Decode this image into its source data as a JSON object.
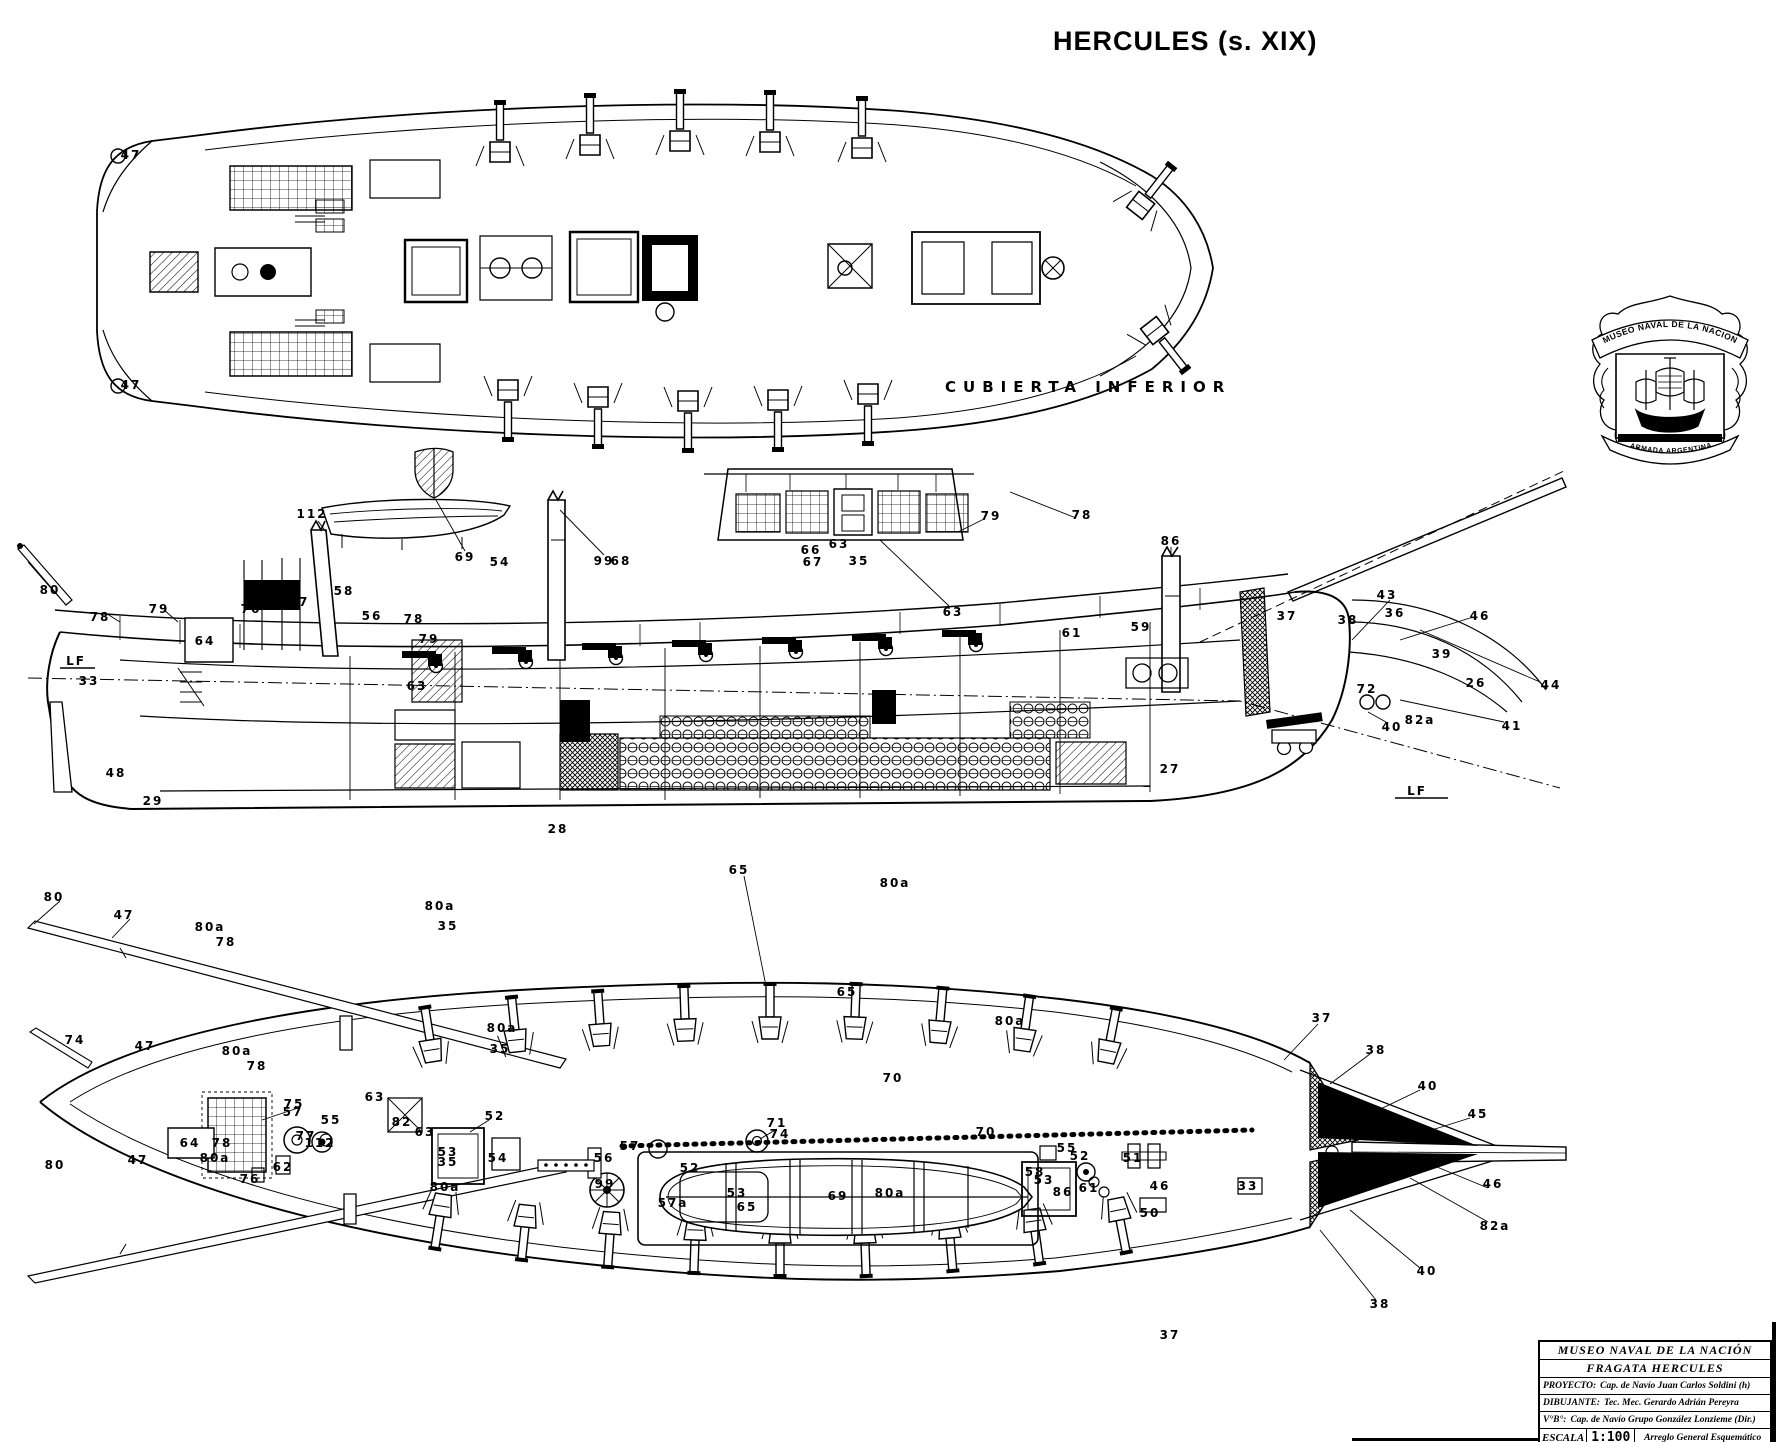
{
  "page_title": "HERCULES (s. XIX)",
  "palette": {
    "ink": "#000000",
    "paper": "#ffffff"
  },
  "crest": {
    "top_banner": "MUSEO NAVAL DE LA NACION",
    "bottom_banner": "ARMADA ARGENTINA"
  },
  "title_block": {
    "line1": "MUSEO NAVAL DE LA NACIÓN",
    "line2": "FRAGATA HERCULES",
    "proyecto_label": "PROYECTO:",
    "proyecto_value": "Cap. de Navío Juan Carlos Soldini (h)",
    "dibujante_label": "DIBUJANTE:",
    "dibujante_value": "Tec. Mec. Gerardo Adrián Pereyra",
    "vb_label": "V°B°:",
    "vb_value": "Cap. de Navío Grupo González Lonzieme (Dir.)",
    "escala_label": "ESCALA",
    "escala_value": "1:100",
    "drawing_title": "Arreglo General Esquemático"
  },
  "views": [
    {
      "key": "cubierta-inferior-plan",
      "label": "CUBIERTA INFERIOR",
      "callouts": [
        {
          "t": "47",
          "x": 131,
          "y": 155
        },
        {
          "t": "47",
          "x": 131,
          "y": 385
        }
      ]
    },
    {
      "key": "longitudinal-section",
      "label": "",
      "callouts": [
        {
          "t": "80",
          "x": 50,
          "y": 590
        },
        {
          "t": "78",
          "x": 100,
          "y": 617
        },
        {
          "t": "79",
          "x": 159,
          "y": 609
        },
        {
          "t": "64",
          "x": 205,
          "y": 641
        },
        {
          "t": "76",
          "x": 251,
          "y": 609
        },
        {
          "t": "77",
          "x": 299,
          "y": 602
        },
        {
          "t": "112",
          "x": 312,
          "y": 514
        },
        {
          "t": "58",
          "x": 344,
          "y": 591
        },
        {
          "t": "56",
          "x": 372,
          "y": 616
        },
        {
          "t": "78",
          "x": 414,
          "y": 619
        },
        {
          "t": "79",
          "x": 429,
          "y": 639
        },
        {
          "t": "33",
          "x": 89,
          "y": 681
        },
        {
          "t": "63",
          "x": 417,
          "y": 686
        },
        {
          "t": "69",
          "x": 465,
          "y": 557
        },
        {
          "t": "54",
          "x": 500,
          "y": 562
        },
        {
          "t": "99",
          "x": 604,
          "y": 561
        },
        {
          "t": "68",
          "x": 621,
          "y": 561
        },
        {
          "t": "63",
          "x": 839,
          "y": 544
        },
        {
          "t": "66",
          "x": 811,
          "y": 550
        },
        {
          "t": "67",
          "x": 813,
          "y": 562
        },
        {
          "t": "35",
          "x": 859,
          "y": 561
        },
        {
          "t": "79",
          "x": 991,
          "y": 516
        },
        {
          "t": "78",
          "x": 1082,
          "y": 515
        },
        {
          "t": "63",
          "x": 953,
          "y": 612
        },
        {
          "t": "86",
          "x": 1171,
          "y": 541
        },
        {
          "t": "61",
          "x": 1072,
          "y": 633
        },
        {
          "t": "59",
          "x": 1141,
          "y": 627
        },
        {
          "t": "37",
          "x": 1287,
          "y": 616
        },
        {
          "t": "38",
          "x": 1348,
          "y": 620
        },
        {
          "t": "43",
          "x": 1387,
          "y": 595
        },
        {
          "t": "36",
          "x": 1395,
          "y": 613
        },
        {
          "t": "46",
          "x": 1480,
          "y": 616
        },
        {
          "t": "39",
          "x": 1442,
          "y": 654
        },
        {
          "t": "26",
          "x": 1476,
          "y": 683
        },
        {
          "t": "44",
          "x": 1551,
          "y": 685
        },
        {
          "t": "72",
          "x": 1367,
          "y": 689
        },
        {
          "t": "40",
          "x": 1392,
          "y": 727
        },
        {
          "t": "82a",
          "x": 1420,
          "y": 720
        },
        {
          "t": "41",
          "x": 1512,
          "y": 726
        },
        {
          "t": "LF",
          "x": 76,
          "y": 661
        },
        {
          "t": "LF",
          "x": 1417,
          "y": 791
        },
        {
          "t": "27",
          "x": 1170,
          "y": 769
        },
        {
          "t": "48",
          "x": 116,
          "y": 773
        },
        {
          "t": "29",
          "x": 153,
          "y": 801
        },
        {
          "t": "28",
          "x": 558,
          "y": 829
        }
      ]
    },
    {
      "key": "upper-deck-plan",
      "label": "",
      "callouts": [
        {
          "t": "80",
          "x": 54,
          "y": 897
        },
        {
          "t": "47",
          "x": 124,
          "y": 915
        },
        {
          "t": "80a",
          "x": 210,
          "y": 927
        },
        {
          "t": "78",
          "x": 226,
          "y": 942
        },
        {
          "t": "80a",
          "x": 440,
          "y": 906
        },
        {
          "t": "35",
          "x": 448,
          "y": 926
        },
        {
          "t": "65",
          "x": 739,
          "y": 870
        },
        {
          "t": "80a",
          "x": 895,
          "y": 883
        },
        {
          "t": "37",
          "x": 1322,
          "y": 1018
        },
        {
          "t": "38",
          "x": 1376,
          "y": 1050
        },
        {
          "t": "40",
          "x": 1428,
          "y": 1086
        },
        {
          "t": "45",
          "x": 1478,
          "y": 1114
        },
        {
          "t": "47",
          "x": 145,
          "y": 1046
        },
        {
          "t": "80a",
          "x": 237,
          "y": 1051
        },
        {
          "t": "78",
          "x": 257,
          "y": 1066
        },
        {
          "t": "80a",
          "x": 502,
          "y": 1028
        },
        {
          "t": "35",
          "x": 500,
          "y": 1049
        },
        {
          "t": "65",
          "x": 847,
          "y": 992
        },
        {
          "t": "80a",
          "x": 1010,
          "y": 1021
        },
        {
          "t": "75",
          "x": 294,
          "y": 1104
        },
        {
          "t": "77",
          "x": 306,
          "y": 1136
        },
        {
          "t": "63",
          "x": 425,
          "y": 1132
        },
        {
          "t": "57",
          "x": 293,
          "y": 1112
        },
        {
          "t": "55",
          "x": 331,
          "y": 1120
        },
        {
          "t": "112",
          "x": 320,
          "y": 1143
        },
        {
          "t": "64",
          "x": 190,
          "y": 1143
        },
        {
          "t": "62",
          "x": 283,
          "y": 1167
        },
        {
          "t": "76",
          "x": 250,
          "y": 1179
        },
        {
          "t": "52",
          "x": 495,
          "y": 1116
        },
        {
          "t": "53",
          "x": 448,
          "y": 1152
        },
        {
          "t": "54",
          "x": 498,
          "y": 1158
        },
        {
          "t": "82",
          "x": 402,
          "y": 1122
        },
        {
          "t": "57",
          "x": 630,
          "y": 1146
        },
        {
          "t": "56",
          "x": 604,
          "y": 1158
        },
        {
          "t": "99",
          "x": 605,
          "y": 1184
        },
        {
          "t": "57a",
          "x": 673,
          "y": 1203
        },
        {
          "t": "52",
          "x": 690,
          "y": 1168
        },
        {
          "t": "53",
          "x": 737,
          "y": 1193
        },
        {
          "t": "69",
          "x": 838,
          "y": 1196
        },
        {
          "t": "71",
          "x": 777,
          "y": 1123
        },
        {
          "t": "74",
          "x": 780,
          "y": 1134
        },
        {
          "t": "70",
          "x": 893,
          "y": 1078
        },
        {
          "t": "70",
          "x": 986,
          "y": 1132
        },
        {
          "t": "52",
          "x": 1080,
          "y": 1156
        },
        {
          "t": "53",
          "x": 1044,
          "y": 1180
        },
        {
          "t": "61",
          "x": 1089,
          "y": 1188
        },
        {
          "t": "58",
          "x": 1035,
          "y": 1172
        },
        {
          "t": "55",
          "x": 1067,
          "y": 1148
        },
        {
          "t": "86",
          "x": 1063,
          "y": 1192
        },
        {
          "t": "51",
          "x": 1133,
          "y": 1158
        },
        {
          "t": "46",
          "x": 1160,
          "y": 1186
        },
        {
          "t": "50",
          "x": 1150,
          "y": 1213
        },
        {
          "t": "33",
          "x": 1248,
          "y": 1186
        },
        {
          "t": "46",
          "x": 1493,
          "y": 1184
        },
        {
          "t": "82a",
          "x": 1495,
          "y": 1226
        },
        {
          "t": "40",
          "x": 1427,
          "y": 1271
        },
        {
          "t": "38",
          "x": 1380,
          "y": 1304
        },
        {
          "t": "37",
          "x": 1170,
          "y": 1335
        },
        {
          "t": "74",
          "x": 75,
          "y": 1040
        },
        {
          "t": "80",
          "x": 55,
          "y": 1165
        },
        {
          "t": "47",
          "x": 138,
          "y": 1160
        },
        {
          "t": "80a",
          "x": 215,
          "y": 1158
        },
        {
          "t": "78",
          "x": 222,
          "y": 1143
        },
        {
          "t": "35",
          "x": 448,
          "y": 1162
        },
        {
          "t": "80a",
          "x": 445,
          "y": 1187
        },
        {
          "t": "65",
          "x": 747,
          "y": 1207
        },
        {
          "t": "80a",
          "x": 890,
          "y": 1193
        },
        {
          "t": "63",
          "x": 375,
          "y": 1097
        }
      ]
    }
  ]
}
